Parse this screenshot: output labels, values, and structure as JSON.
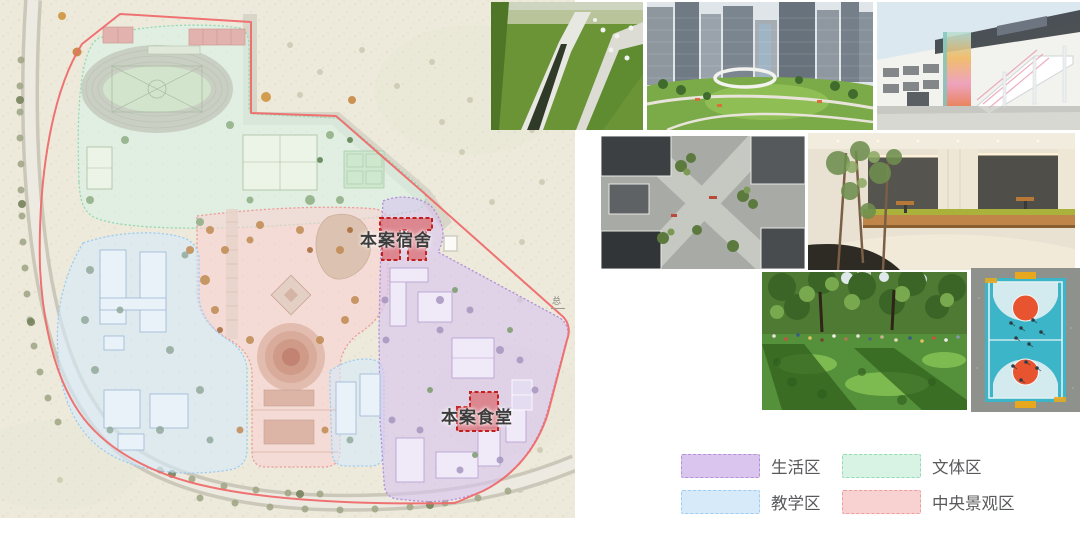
{
  "slide": {
    "background": "#ffffff"
  },
  "site_plan": {
    "name": "campus-functional-zoning-plan",
    "background": "#edeadc",
    "annotations": {
      "dorm": "本案宿舍",
      "canteen": "本案食堂",
      "corner_mark": "总"
    }
  },
  "colors": {
    "living_fill": "#d9c5ee",
    "living_border": "#b490d8",
    "sports_fill": "#d8f2e3",
    "sports_border": "#95dab6",
    "teaching_fill": "#d7eafa",
    "teaching_border": "#9fcdf2",
    "landscape_fill": "#f8d2d1",
    "landscape_border": "#ee9d9b",
    "boundary": "#ef6b6b",
    "highlight_fill": "#d84848",
    "highlight_border": "#c41f1f",
    "label_text": "#3c3c3c",
    "legend_text": "#58595b"
  },
  "legend": {
    "items": [
      {
        "id": "living",
        "label": "生活区"
      },
      {
        "id": "sports",
        "label": "文体区"
      },
      {
        "id": "teaching",
        "label": "教学区"
      },
      {
        "id": "landscape",
        "label": "中央景观区"
      }
    ]
  },
  "photos": [
    {
      "id": "green-roof-park-aerial"
    },
    {
      "id": "urban-park-skyscrapers"
    },
    {
      "id": "school-building-colorful-stairs"
    },
    {
      "id": "courtyard-plaza-aerial"
    },
    {
      "id": "interior-lounge-with-trees"
    },
    {
      "id": "park-lawn-gathering"
    },
    {
      "id": "basketball-court-aerial"
    }
  ]
}
